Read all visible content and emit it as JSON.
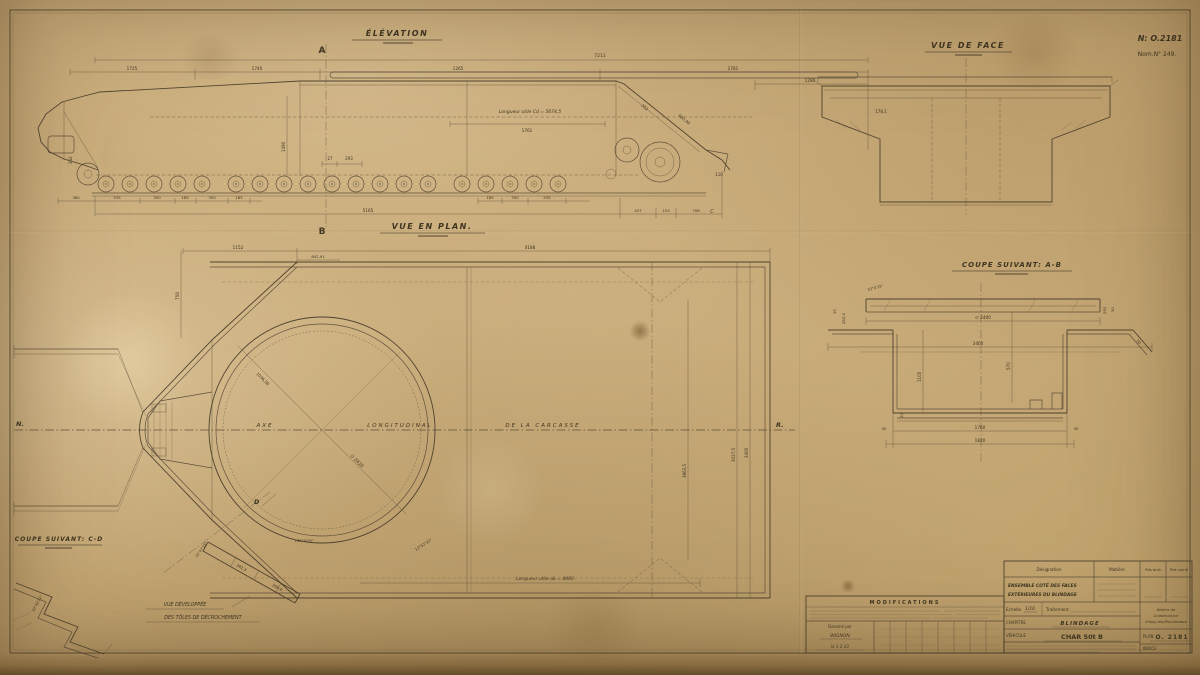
{
  "colors": {
    "paper": "#c8ab77",
    "ink": "#473b28"
  },
  "sheet": {
    "plan_no": "N: O.2181",
    "nom_no": "Nom.N° 249."
  },
  "elevation": {
    "title": "ÉLÉVATION",
    "marker_a": "A",
    "marker_b": "B",
    "marker_c": "C",
    "dim_total": "7211",
    "dims_top": [
      "1725",
      "1740",
      "1265",
      "2781"
    ],
    "dim_1280": "1280",
    "longueur_cd": "Longueur utile Cd = 5674,5",
    "dim_1761": "1761",
    "dims_bottom": [
      "380",
      "535",
      "350",
      "185",
      "350",
      "185"
    ],
    "dim_5165": "5165",
    "dims_bottom_right": [
      "185",
      "350",
      "535"
    ],
    "dims_rear": [
      "437",
      "153",
      "708"
    ],
    "dim_1490": "1490",
    "dim_342": "342",
    "dim_683": "683,46",
    "dim_352": "352",
    "dim_27": "27",
    "dim_293": "293",
    "dim_110": "110"
  },
  "vue_face": {
    "title": "VUE DE FACE",
    "dim_178": "178,1"
  },
  "plan": {
    "title": "VUE EN PLAN.",
    "axe": "AXE",
    "longitudinal": "LONGITUDINAL",
    "carcasse": "DE  LA  CARCASSE",
    "label_n": "N.",
    "label_r": "R.",
    "marker_d": "D",
    "dim_1152": "1152",
    "dim_4188": "4188",
    "dim_842": "842,91",
    "dim_750": "750",
    "dia_2420": "∅ 2420",
    "dim_1036": "1036,56",
    "dim_3027": "3027,5",
    "dim_3400": "3400",
    "dim_3863": "3863,5",
    "longueur_ab": "Longueur utile ab = 4460",
    "angle_165": "165°4'29\"",
    "angle_12": "12°52'33\""
  },
  "coupe_ab": {
    "title": "COUPE SUIVANT: A-B",
    "dia_2400": "∅ 2400",
    "dim_3400": "3400",
    "dim_1105": "1105",
    "dim_570": "570",
    "dim_20": "20",
    "dim_1760": "1760",
    "dim_1820": "1820",
    "dim_30_left": "30",
    "dim_30_right": "30",
    "dim_15": "15",
    "dim_282": "282,4",
    "dim_292": "292",
    "dim_30_top": "30",
    "dim_30_slope": "30",
    "angle_22": "22°0'32\""
  },
  "coupe_cd": {
    "title": "COUPE SUIVANT: C-D",
    "angle": "20°42'22\""
  },
  "developpee": {
    "line1": "VUE DÉVELOPPÉE",
    "line2": "DES TÔLES DE DÉCROCHEMENT",
    "dim_302": "302,3",
    "dim_208": "208,9",
    "angle": "15°47'33\""
  },
  "modifications": {
    "title": "MODIFICATIONS",
    "drawn_label": "Dessiné par",
    "drawn_name": "WIGNON",
    "drawn_date": "le 1-2-33"
  },
  "titleblock": {
    "headers": [
      "Désignation",
      "Matière",
      "Pds brut",
      "Pds usiné"
    ],
    "designation_l1": "ENSEMBLE COTÉ DES FACES",
    "designation_l2": "EXTÉRIEURES DU BLINDAGE",
    "echelle_label": "Echelle",
    "echelle_value": "1/10",
    "traitement_label": "Traitement",
    "chapitre_label": "CHAPITRE",
    "chapitre_value": "BLINDAGE",
    "vehicule_label": "VÉHICULE",
    "vehicule_value": "CHAR 50t B",
    "atelier_l1": "Atelier de",
    "atelier_l2": "Construction",
    "atelier_l3": "d'Issy-les-Moulineaux",
    "plan_label": "PLAN",
    "plan_value": "O. 2181",
    "indice_label": "INDICE"
  }
}
